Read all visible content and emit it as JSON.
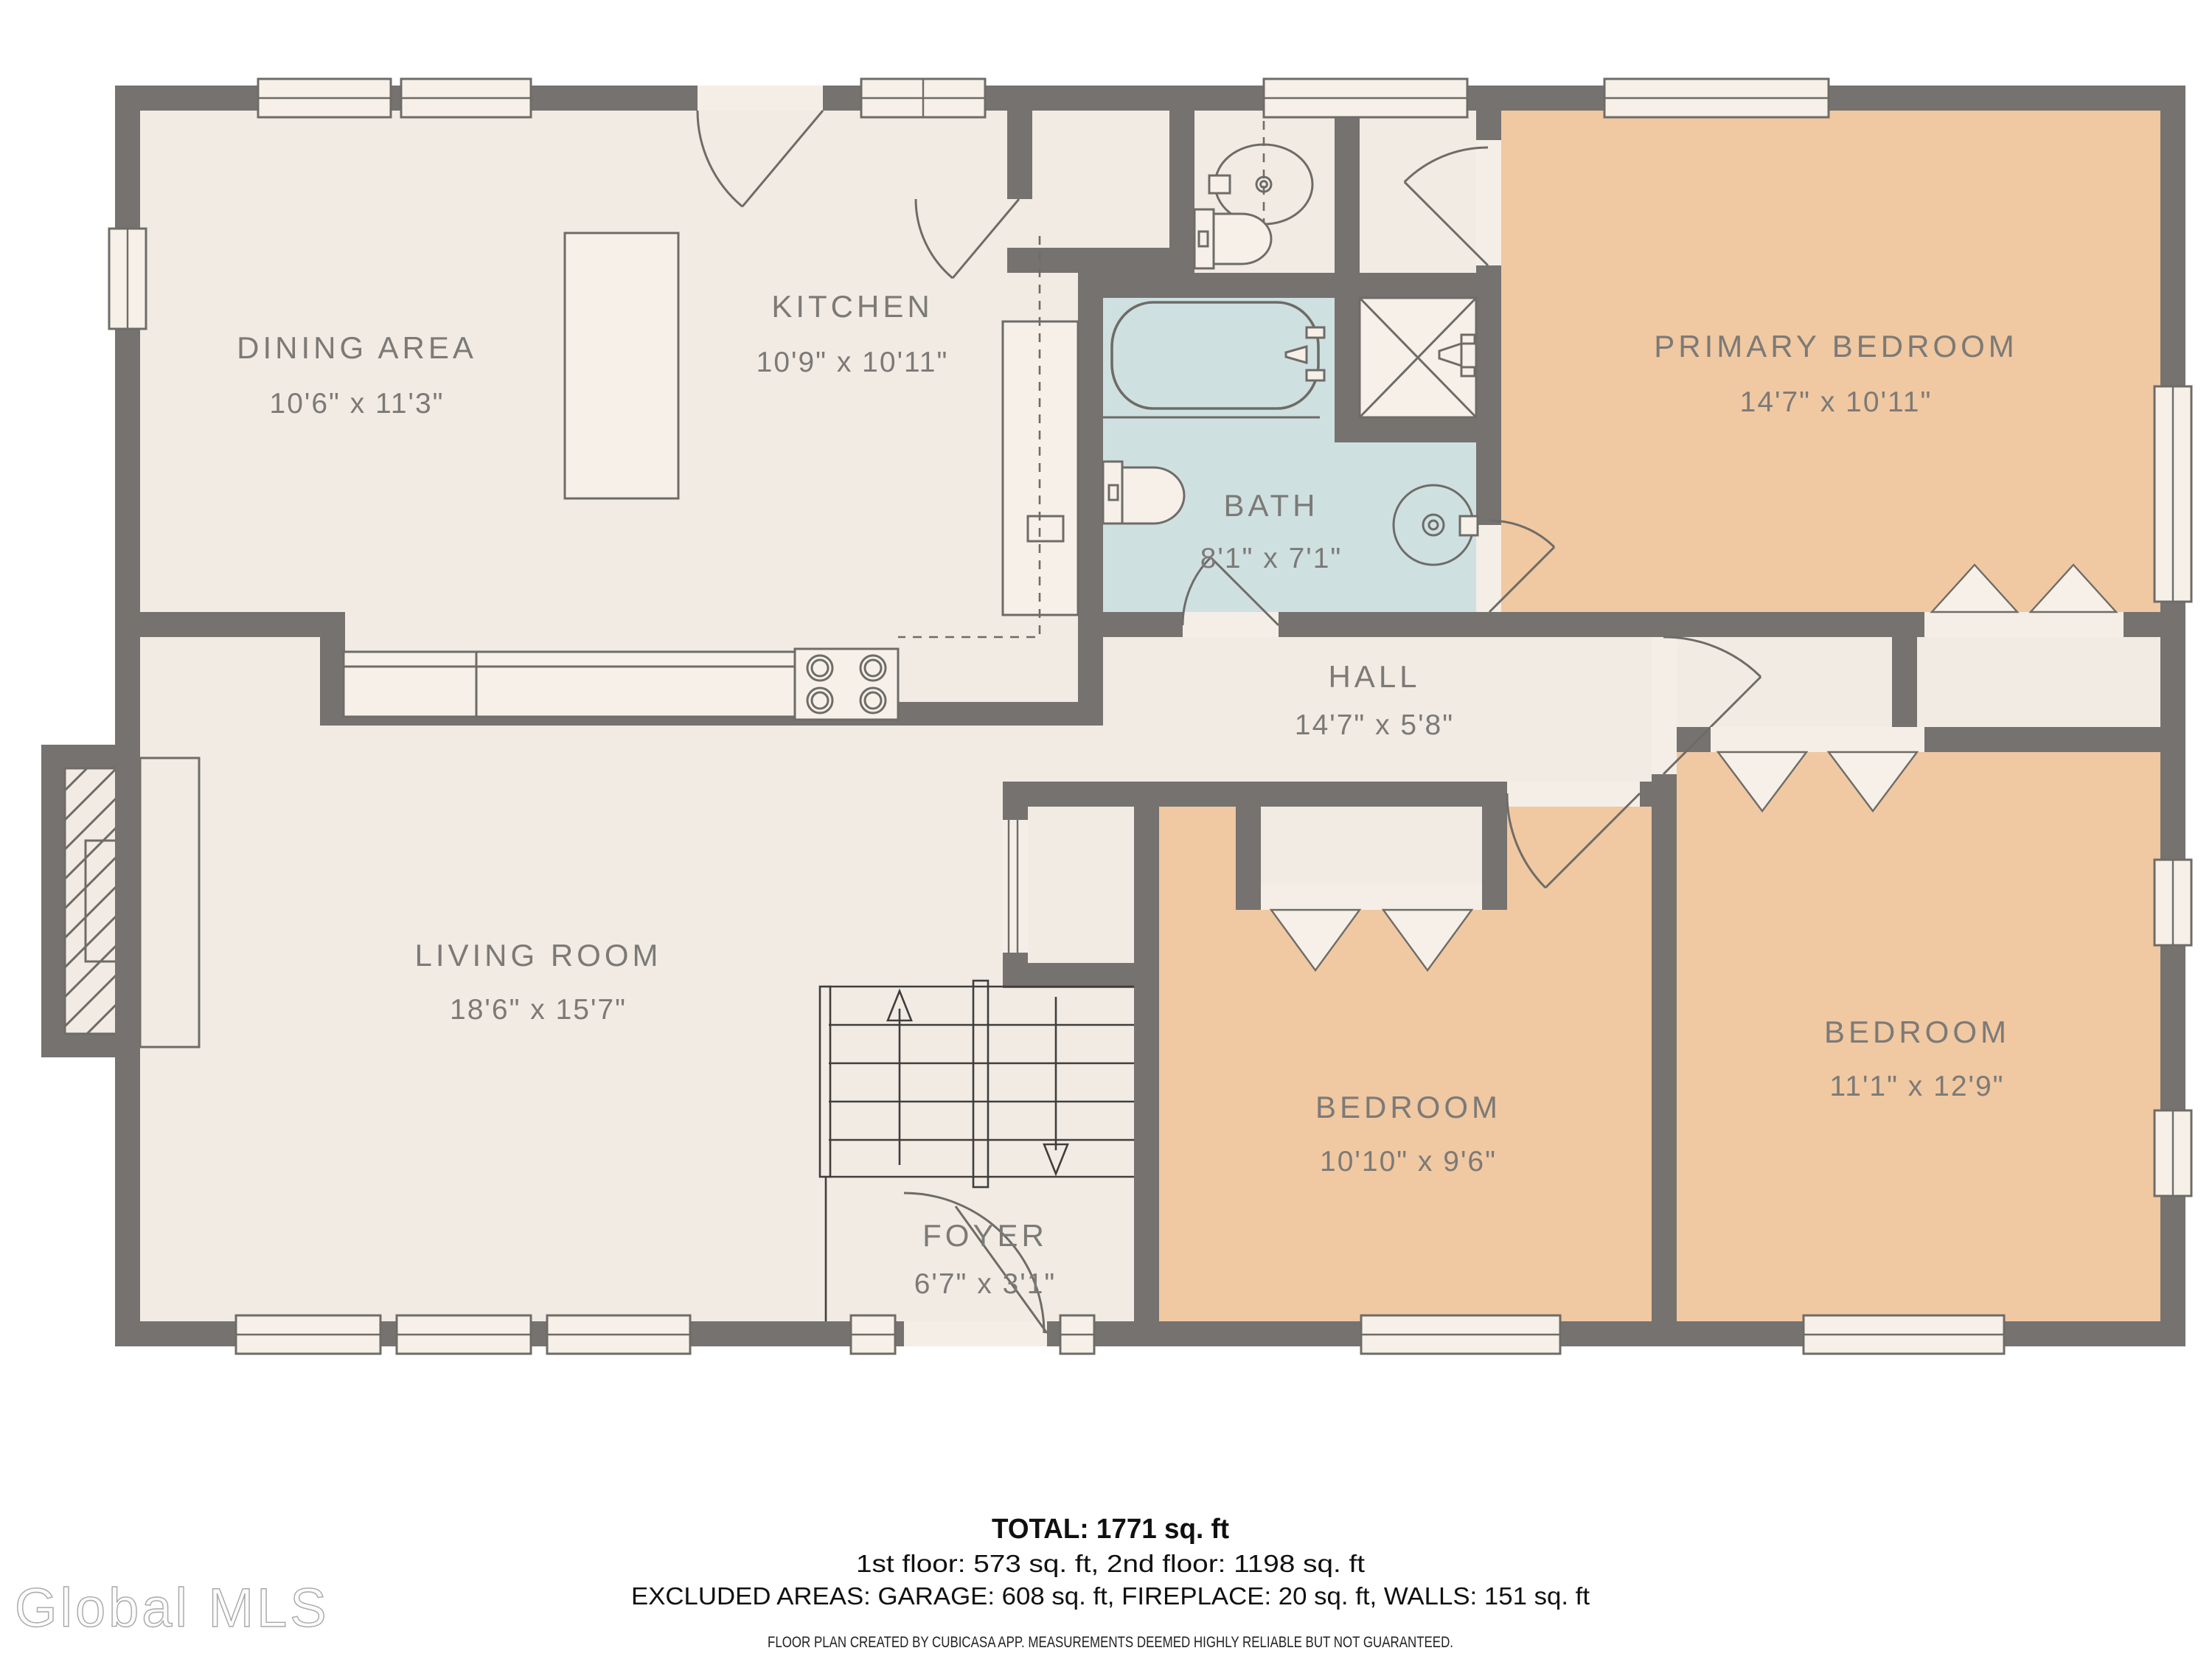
{
  "rooms": [
    {
      "name": "DINING AREA",
      "dims": "10'6\" x 11'3\""
    },
    {
      "name": "KITCHEN",
      "dims": "10'9\" x 10'11\""
    },
    {
      "name": "PRIMARY BEDROOM",
      "dims": "14'7\" x 10'11\""
    },
    {
      "name": "BATH",
      "dims": "8'1\" x 7'1\""
    },
    {
      "name": "HALL",
      "dims": "14'7\" x 5'8\""
    },
    {
      "name": "LIVING ROOM",
      "dims": "18'6\" x 15'7\""
    },
    {
      "name": "BEDROOM",
      "dims": "10'10\" x 9'6\""
    },
    {
      "name": "BEDROOM",
      "dims": "11'1\" x 12'9\""
    },
    {
      "name": "FOYER",
      "dims": "6'7\" x 3'1\""
    }
  ],
  "summary": {
    "total": "TOTAL: 1771 sq. ft",
    "floors": "1st floor: 573 sq. ft, 2nd floor: 1198 sq. ft",
    "excluded": "EXCLUDED AREAS: GARAGE: 608 sq. ft, FIREPLACE: 20 sq. ft, WALLS: 151 sq. ft",
    "disclaimer": "FLOOR PLAN CREATED BY CUBICASA APP. MEASUREMENTS DEEMED HIGHLY RELIABLE BUT NOT GUARANTEED."
  },
  "watermark": "Global MLS",
  "colors": {
    "wall": "#757270",
    "floor": "#f2ebe4",
    "bedroom": "#f0c8a2",
    "bath": "#cfe0e1",
    "label_text": "#7c7a76",
    "summary_text": "#101010"
  }
}
